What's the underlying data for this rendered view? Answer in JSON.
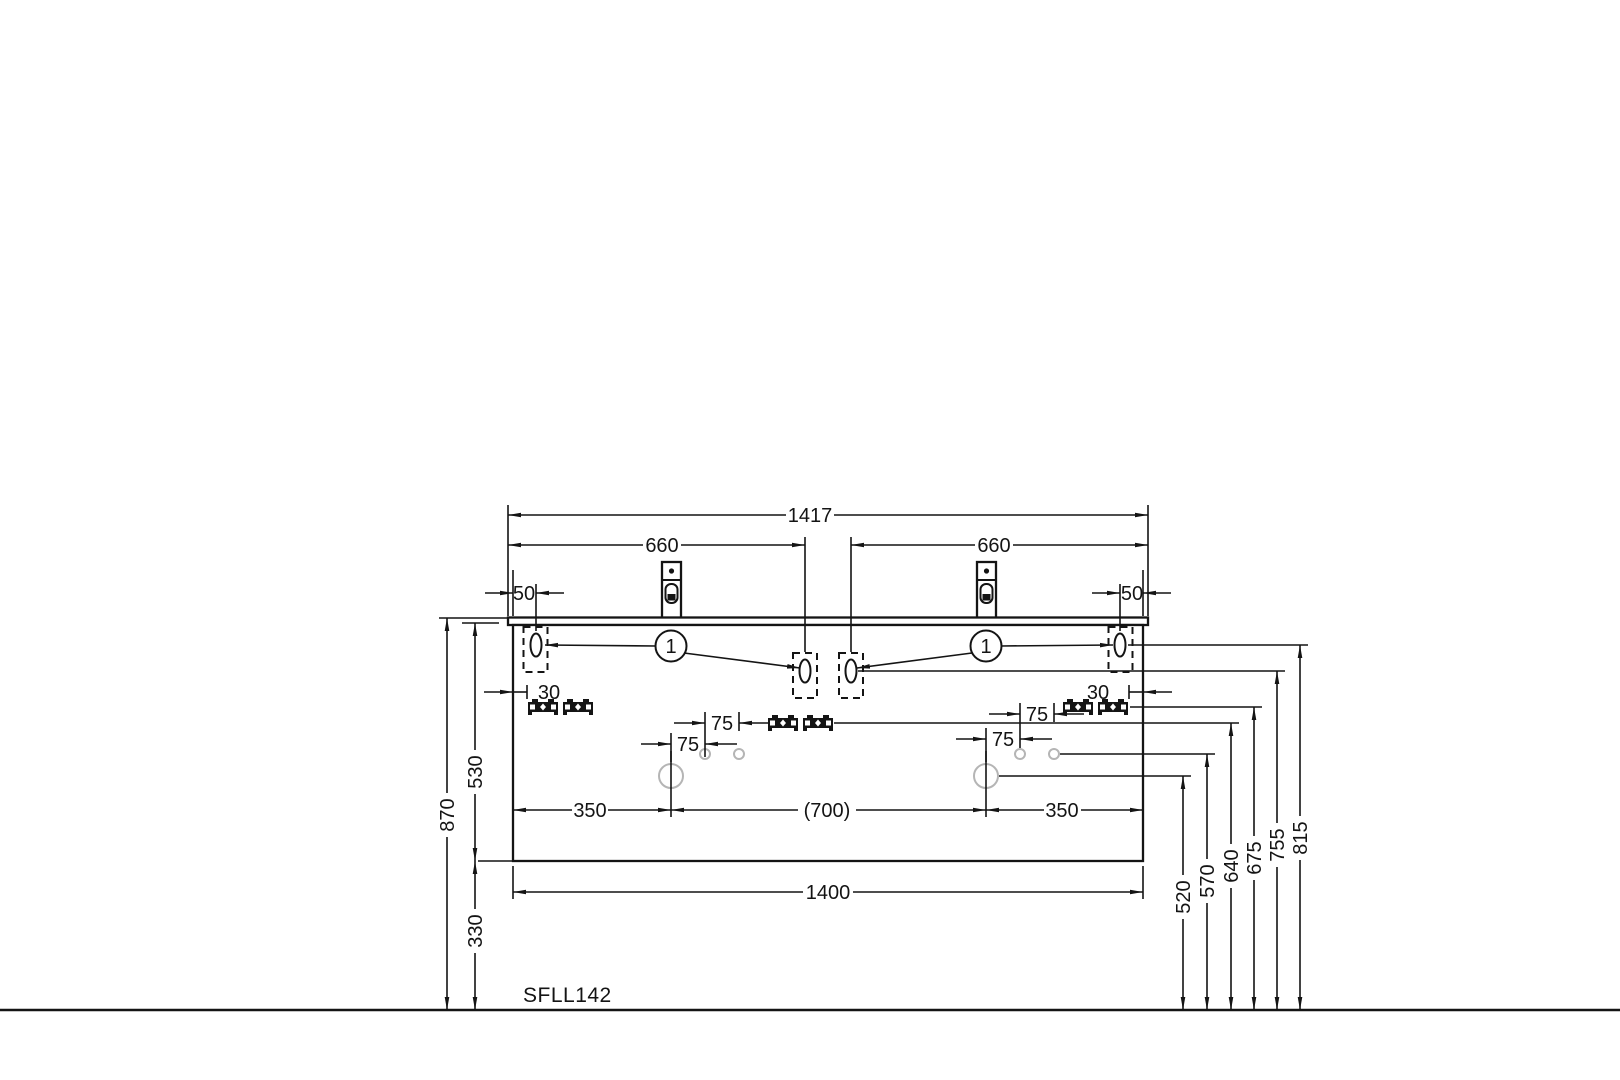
{
  "drawing": {
    "model": "SFLL142",
    "type": "vanity installation dimension drawing",
    "colors": {
      "line": "#141414",
      "hole_outline": "#b5b5b5",
      "background": "#ffffff"
    }
  },
  "labels": {
    "model": "SFLL142",
    "countertop_width": "1417",
    "hanger_spacing": "660",
    "side_offset": "50",
    "clip_offset": "30",
    "hole_pitch": "75",
    "drain_edge_offset": "350",
    "drain_spacing": "(700)",
    "cabinet_width": "1400",
    "overall_height": "870",
    "cabinet_height": "530",
    "bottom_clearance": "330",
    "balloon_1": "1",
    "height_520": "520",
    "height_570": "570",
    "height_640": "640",
    "height_675": "675",
    "height_755": "755",
    "height_815": "815"
  }
}
